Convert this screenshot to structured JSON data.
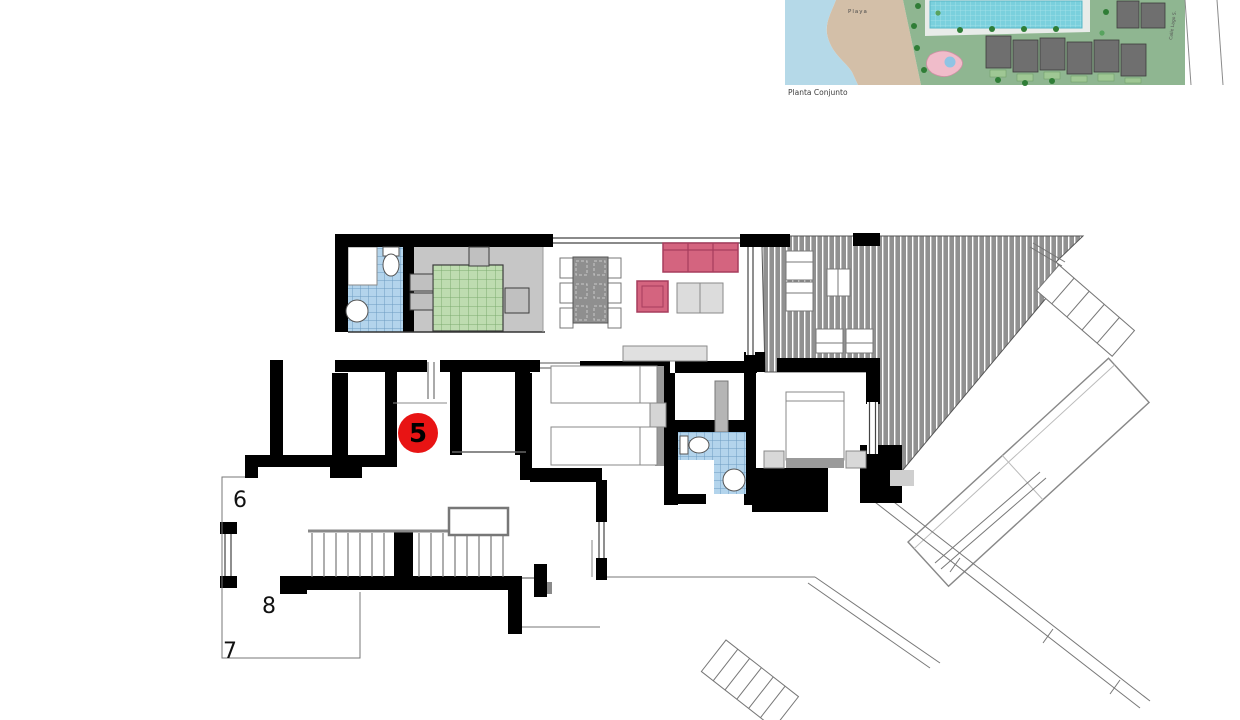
{
  "site_plan": {
    "caption": "Planta Conjunto",
    "beach_label": "Playa",
    "street_label": "Calle Lago S.",
    "colors": {
      "sea": "#b5d9e8",
      "beach": "#d3bfa8",
      "green": "#8fb691",
      "pool": "#7ad0dd",
      "pink_pool": "#f0bcca",
      "building": "#6f6f6f"
    }
  },
  "floor_plan": {
    "unit_marker": {
      "label": "5",
      "circle_color": "#e81414",
      "text_color": "#000000"
    },
    "level_labels": [
      {
        "label": "6"
      },
      {
        "label": "8"
      },
      {
        "label": "7"
      }
    ],
    "colors": {
      "wall": "#000000",
      "bath_tile": "#b3d4ec",
      "bath_tile_grid": "#6d9cc2",
      "kitchen_tile": "#bedcb0",
      "kitchen_tile_grid": "#7dab70",
      "kitchen_floor": "#c6c6c6",
      "terrace_deck": "#919191",
      "sofa": "#d4647f",
      "sofa_border": "#a63d5d",
      "furniture_light": "#dcdcdc",
      "furniture_mid": "#8f8f8f"
    }
  }
}
